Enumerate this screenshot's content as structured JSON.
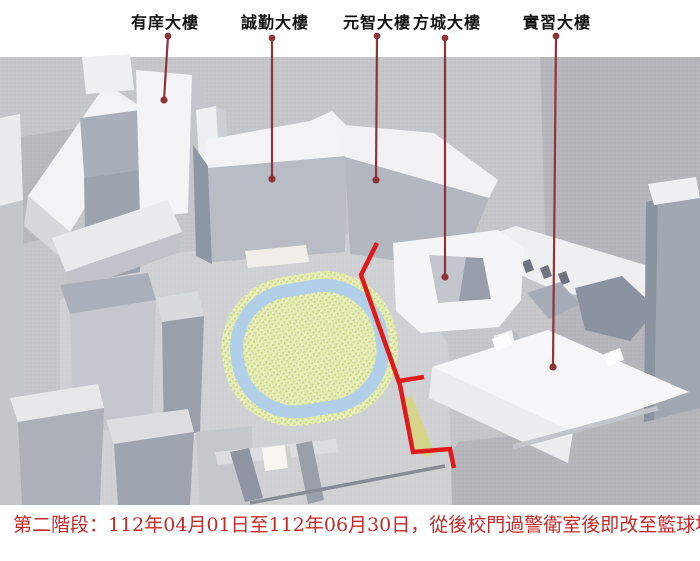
{
  "map": {
    "building_labels": [
      {
        "text": "有庠大樓"
      },
      {
        "text": "誠勤大樓"
      },
      {
        "text": "元智大樓"
      },
      {
        "text": "方城大樓"
      },
      {
        "text": "實習大樓"
      }
    ],
    "colors": {
      "route_highlight": "#e0191c",
      "leader_line": "#8e3338",
      "track_ring_blue": "#b2cfe9",
      "track_infield_green": "#e3eab2",
      "label_text": "#111111",
      "caption_text": "#c42a2a"
    }
  },
  "caption": {
    "text": "第二階段：112年04月01日至112年06月30日，從後校門過警衛室後即改至籃球場旁通道。"
  }
}
